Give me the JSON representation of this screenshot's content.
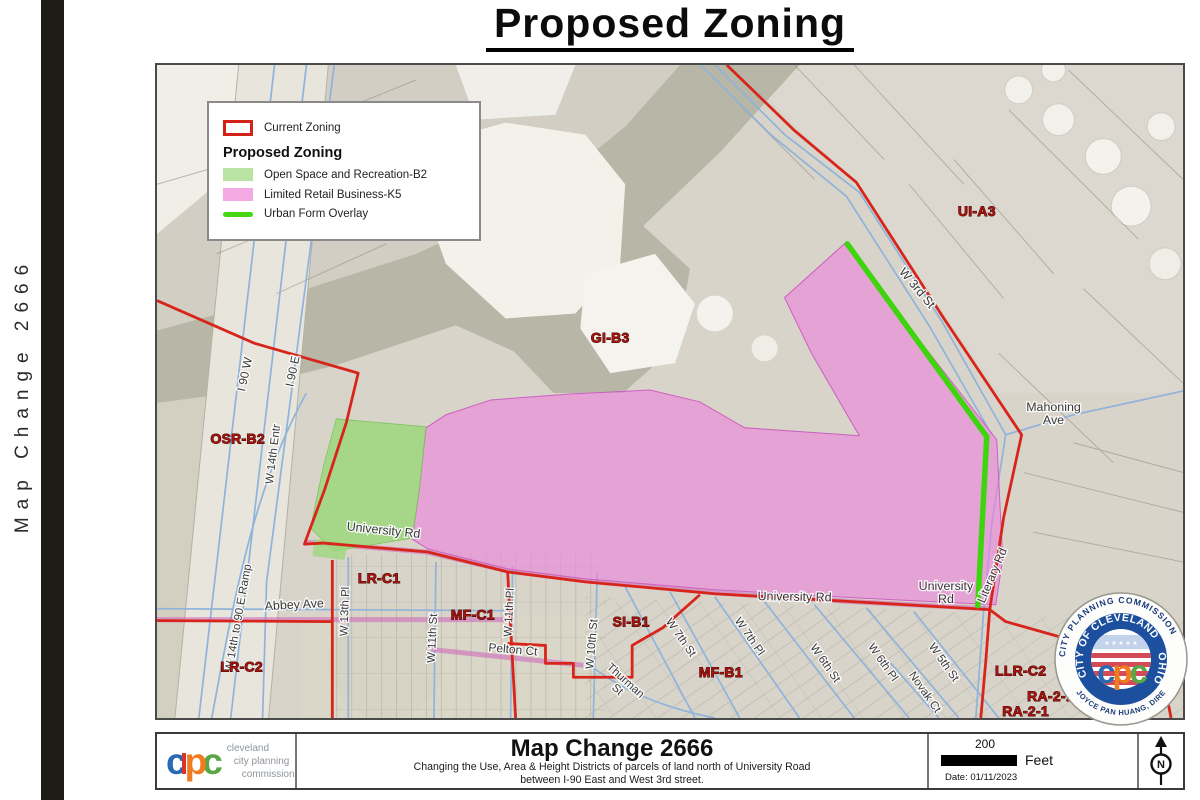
{
  "page": {
    "title": "Proposed Zoning",
    "side_label": "Map Change 2666"
  },
  "legend": {
    "current_zoning": "Current Zoning",
    "header": "Proposed Zoning",
    "items": [
      {
        "label": "Open Space and Recreation-B2",
        "swatch": "green-fill",
        "color": "#b9e3a2"
      },
      {
        "label": "Limited Retail Business-K5",
        "swatch": "pink-fill",
        "color": "#f2a9e4"
      },
      {
        "label": "Urban Form Overlay",
        "swatch": "green-line",
        "color": "#46d613"
      }
    ]
  },
  "map": {
    "zone_labels": [
      {
        "text": "UI-A3",
        "x": 823,
        "y": 152
      },
      {
        "text": "GI-B3",
        "x": 455,
        "y": 279
      },
      {
        "text": "OSR-B2",
        "x": 81,
        "y": 381
      },
      {
        "text": "LR-C1",
        "x": 223,
        "y": 521
      },
      {
        "text": "MF-C1",
        "x": 317,
        "y": 558
      },
      {
        "text": "SI-B1",
        "x": 476,
        "y": 565
      },
      {
        "text": "MF-B1",
        "x": 566,
        "y": 616
      },
      {
        "text": "LR-C2",
        "x": 85,
        "y": 610
      },
      {
        "text": "LLR-C2",
        "x": 867,
        "y": 614
      },
      {
        "text": "RA-2-1",
        "x": 897,
        "y": 640
      },
      {
        "text": "RA-2-1",
        "x": 872,
        "y": 655
      }
    ],
    "street_labels": [
      {
        "text": "I 90 W",
        "x": 92,
        "y": 312,
        "rot": -78,
        "size": 12
      },
      {
        "text": "I 90 E",
        "x": 140,
        "y": 309,
        "rot": -78,
        "size": 12
      },
      {
        "text": "W 14th Entr",
        "x": 120,
        "y": 392,
        "rot": -83,
        "size": 11.5
      },
      {
        "text": "W 14th to 90 E Ramp",
        "x": 85,
        "y": 557,
        "rot": -80,
        "size": 11.5
      },
      {
        "text": "Abbey Ave",
        "x": 138,
        "y": 547,
        "rot": -3,
        "size": 12.5
      },
      {
        "text": "W 13th Pl",
        "x": 192,
        "y": 550,
        "rot": -88,
        "size": 11.5
      },
      {
        "text": "W 11th St",
        "x": 280,
        "y": 577,
        "rot": -87,
        "size": 11.5
      },
      {
        "text": "W 11th Pl",
        "x": 357,
        "y": 551,
        "rot": -87,
        "size": 11.5
      },
      {
        "text": "Pelton Ct",
        "x": 357,
        "y": 592,
        "rot": 5,
        "size": 12
      },
      {
        "text": "W 10th St",
        "x": 440,
        "y": 583,
        "rot": -85,
        "size": 11.5
      },
      {
        "text": "Thurman\nSt",
        "x": 468,
        "y": 622,
        "rot": 42,
        "size": 11.5
      },
      {
        "text": "W 7th St",
        "x": 523,
        "y": 578,
        "rot": 55,
        "size": 11.5
      },
      {
        "text": "W 7th Pl",
        "x": 592,
        "y": 577,
        "rot": 55,
        "size": 11.5
      },
      {
        "text": "W 6th St",
        "x": 668,
        "y": 604,
        "rot": 55,
        "size": 11.5
      },
      {
        "text": "W 6th Pl",
        "x": 726,
        "y": 603,
        "rot": 55,
        "size": 11.5
      },
      {
        "text": "W 5th St",
        "x": 787,
        "y": 603,
        "rot": 55,
        "size": 11.5
      },
      {
        "text": "Novak Ct",
        "x": 768,
        "y": 633,
        "rot": 55,
        "size": 11.5
      },
      {
        "text": "W 3rd St",
        "x": 760,
        "y": 227,
        "rot": 50,
        "size": 12.5
      },
      {
        "text": "Mahoning\nAve",
        "x": 900,
        "y": 348,
        "rot": 0,
        "size": 12.5
      },
      {
        "text": "University Rd",
        "x": 227,
        "y": 472,
        "rot": 6,
        "size": 12.5
      },
      {
        "text": "University Rd",
        "x": 640,
        "y": 539,
        "rot": 1,
        "size": 12.5
      },
      {
        "text": "University\nRd",
        "x": 792,
        "y": 528,
        "rot": 0,
        "size": 12.5
      },
      {
        "text": "Literary Rd",
        "x": 842,
        "y": 515,
        "rot": -67,
        "size": 12
      }
    ]
  },
  "seal": {
    "outer_top": "CITY PLANNING COMMISSION",
    "outer_bottom": "JOYCE PAN HUANG, DIRECTOR",
    "inner_left": "CITY OF CLEVELAND",
    "inner_right": "OHIO",
    "monogram_c1": "c",
    "monogram_p": "p",
    "monogram_c2": "c"
  },
  "footer": {
    "logo_c1": "c",
    "logo_p": "p",
    "logo_c2": "c",
    "org_lines": [
      "cleveland",
      "city planning",
      "commission"
    ],
    "title": "Map Change 2666",
    "description_1": "Changing the Use, Area & Height Districts of parcels of land north of University Road",
    "description_2": "between I-90 East and West 3rd street.",
    "scale_value": "200",
    "scale_unit": "Feet",
    "date": "Date: 01/11/2023",
    "north": "N"
  },
  "colors": {
    "current_zoning_red": "#d8251b",
    "open_space_green": "#a8dd8a",
    "retail_pink": "#ec82dc",
    "urban_form_green": "#3ed40e",
    "street_blue": "#8fb3da",
    "zone_label_red": "#a81310",
    "sidebar_black": "#1d1d15"
  }
}
